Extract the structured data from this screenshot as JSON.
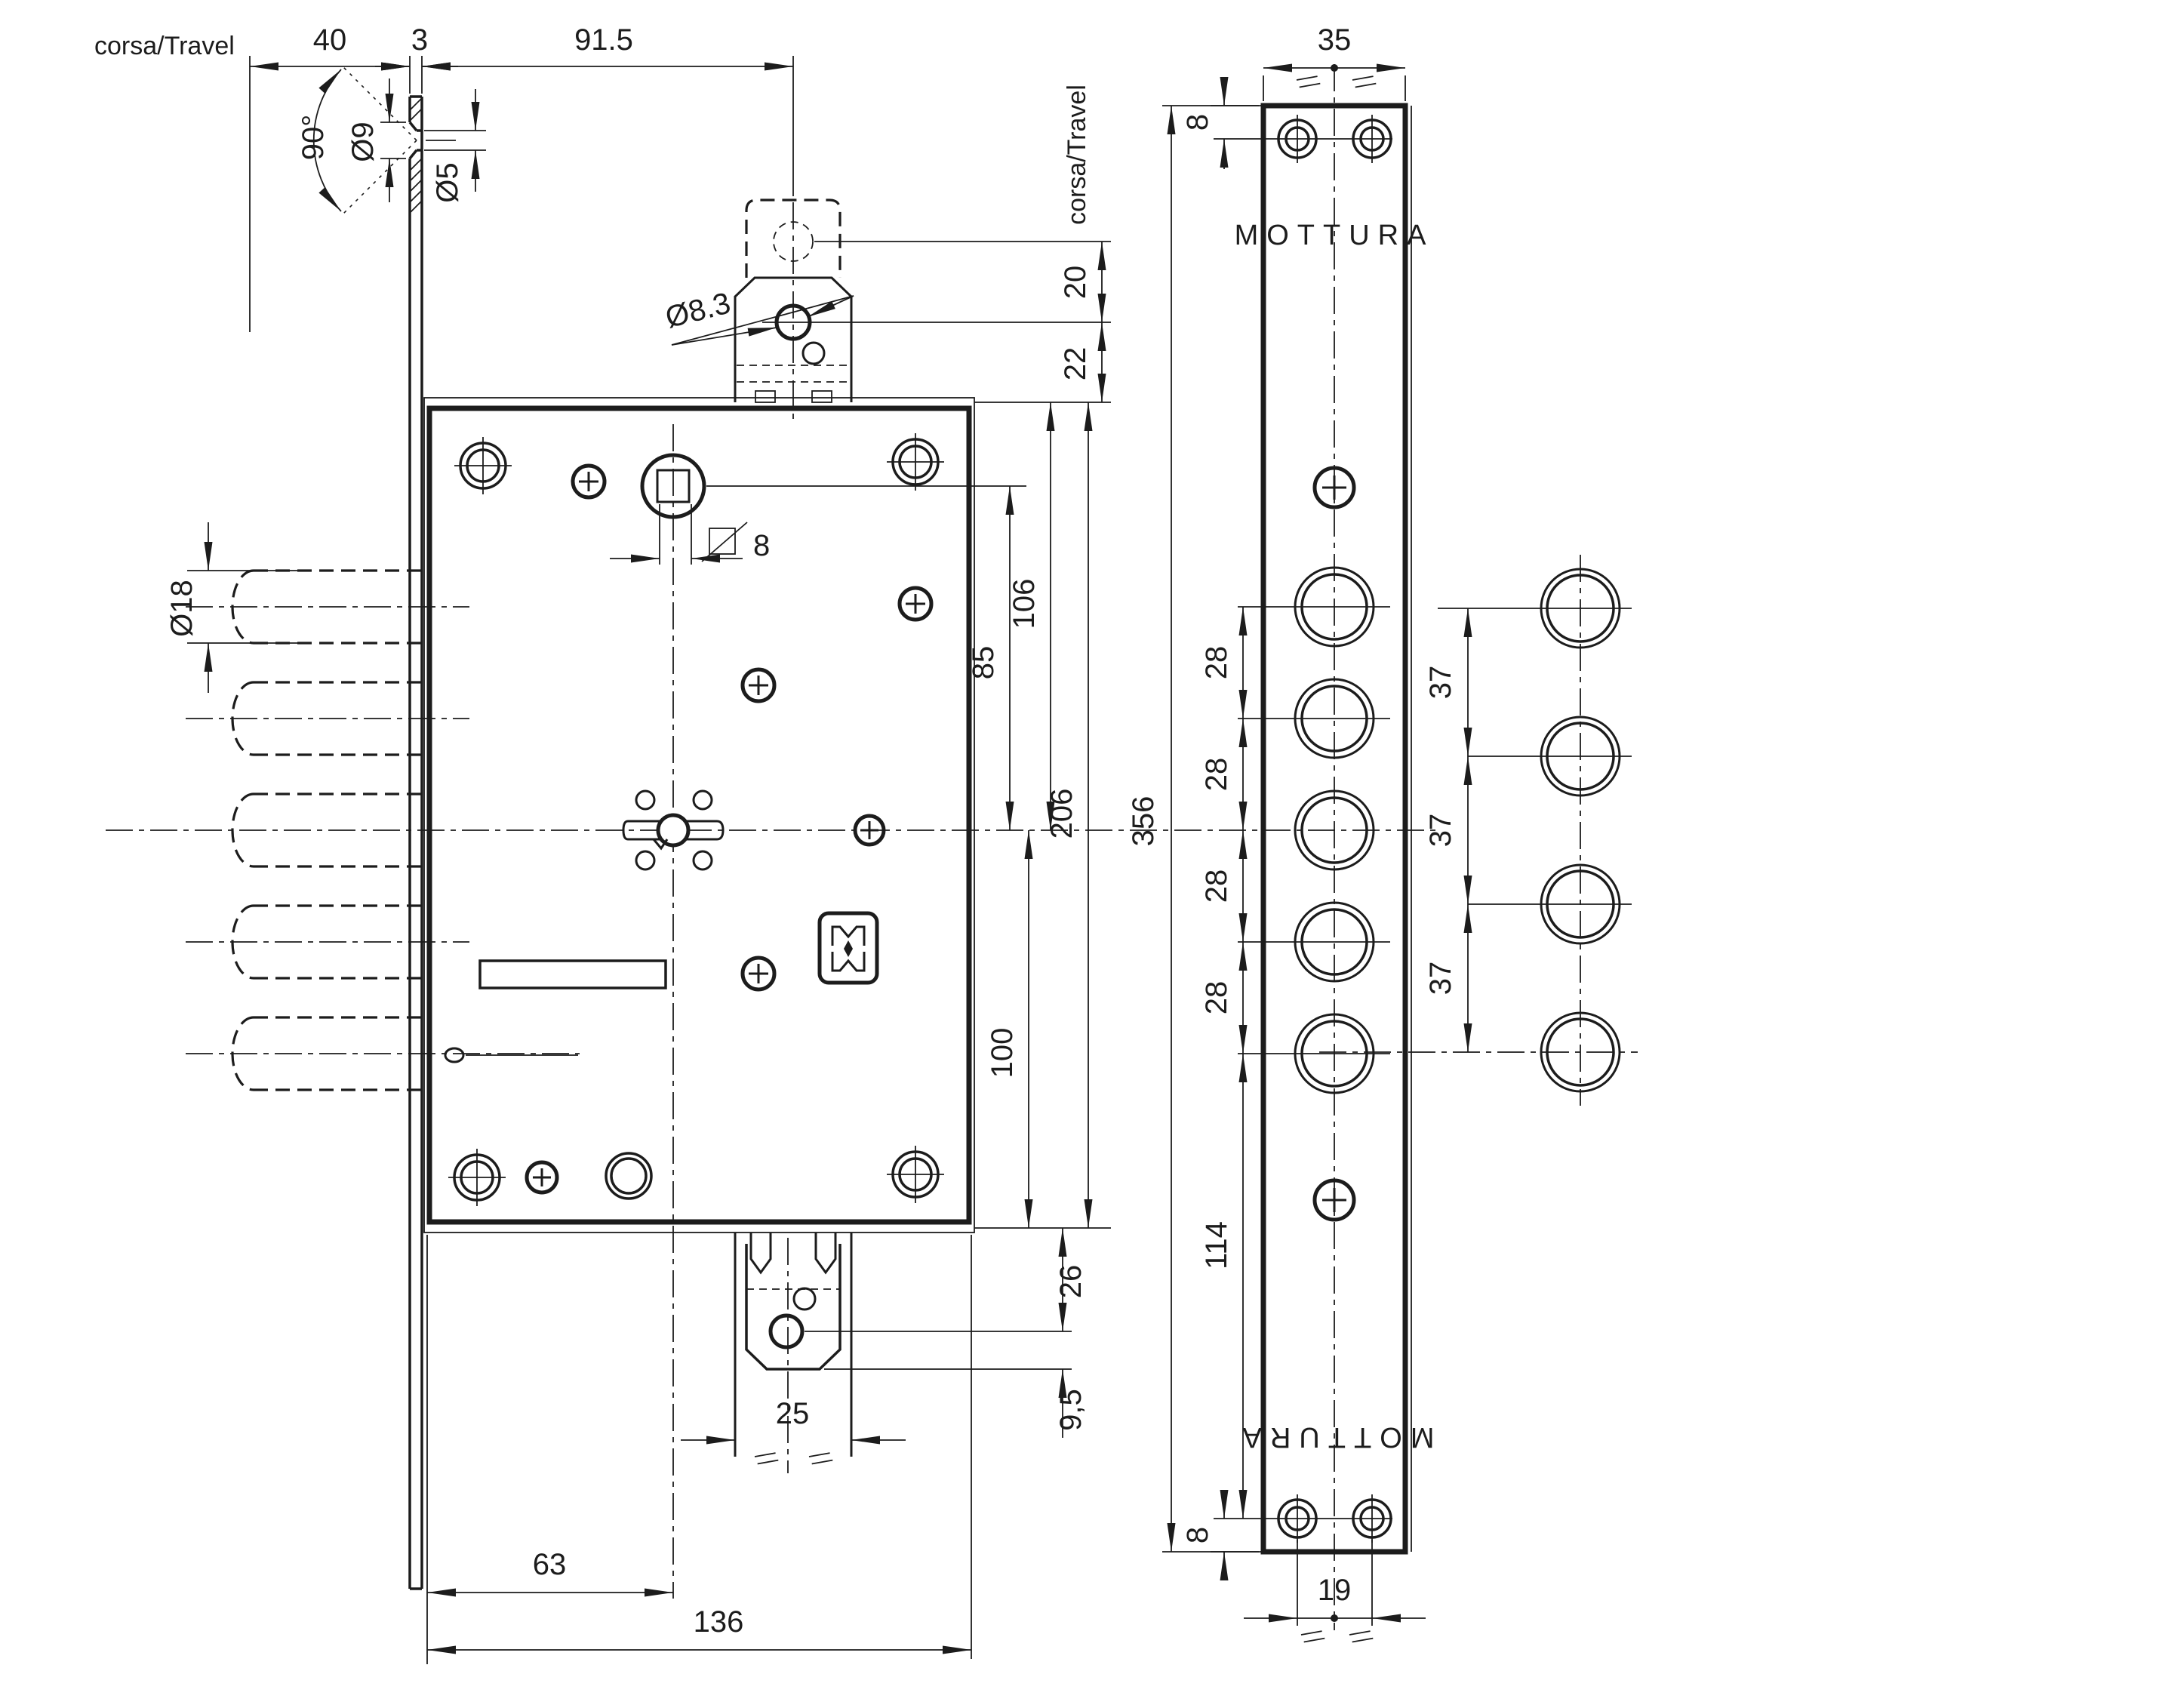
{
  "drawing": {
    "background": "#ffffff",
    "line_color": "#1c1c1c"
  },
  "labels": {
    "corsa_travel_top": "corsa/Travel",
    "corsa_travel_right": "corsa/Travel"
  },
  "brand": {
    "top": "MOTTURA",
    "bottom": "MOTTURA"
  },
  "front_view": {
    "dims": {
      "travel": "40",
      "plate_thickness": "3",
      "tab_backset": "91.5",
      "countersink_angle": "90°",
      "countersink_dia": "Ø9",
      "screw_hole_dia": "Ø5",
      "tab_hole_dia": "Ø8.3",
      "tab_travel": "20",
      "tab_hole_to_case": "22",
      "bolt_dia": "Ø18",
      "spindle_square": "8",
      "case_top_to_axis": "106",
      "spindle_to_axis": "85",
      "case_height": "206",
      "axis_to_case_bottom": "100",
      "case_to_tab_hole": "26",
      "tab_hole_to_end": "9,5",
      "tab_width": "25",
      "key_backset": "63",
      "case_width": "136"
    }
  },
  "faceplate_view": {
    "dims": {
      "width": "35",
      "screw_top_offset": "8",
      "screw_bottom_offset": "8",
      "height": "356",
      "bolt_spacing": [
        "28",
        "28",
        "28",
        "28"
      ],
      "last_bolt_to_screw": "114",
      "screw_spacing": "19"
    }
  },
  "deviator_view": {
    "dims": {
      "spacing": [
        "37",
        "37",
        "37"
      ]
    }
  }
}
